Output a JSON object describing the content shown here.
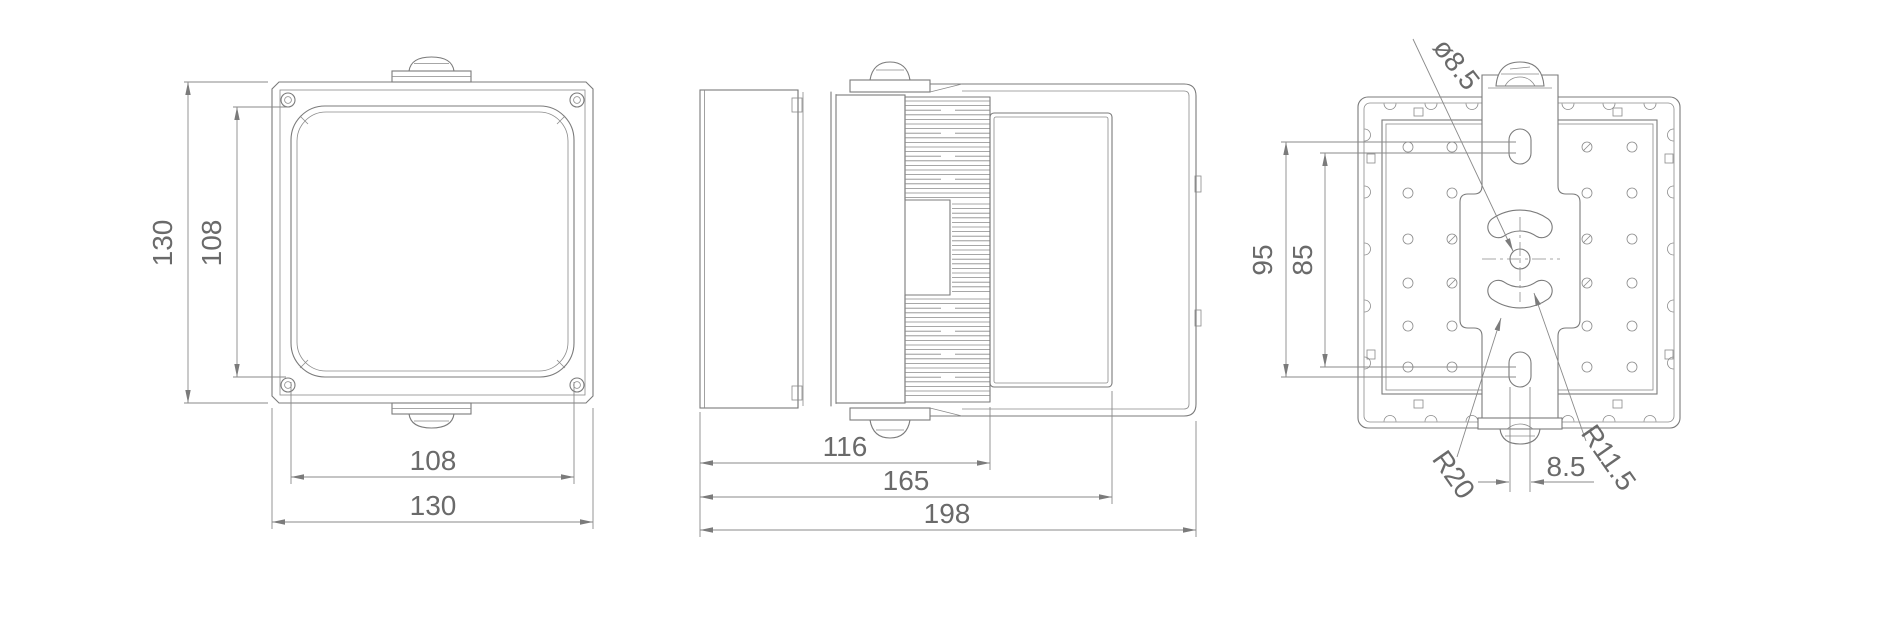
{
  "drawing": {
    "kind": "technical-orthographic-drawing",
    "line_color": "#7b7b7b",
    "text_color": "#6a6a6a",
    "background": "#ffffff",
    "views": {
      "front": {
        "dimensions": {
          "height_outer": "130",
          "height_inner": "108",
          "width_inner": "108",
          "width_outer": "130"
        }
      },
      "side": {
        "dimensions": {
          "depth_front": "116",
          "depth_mid": "165",
          "depth_overall": "198"
        }
      },
      "back": {
        "dimensions": {
          "hole_diameter": "ø8.5",
          "pitch_outer": "95",
          "pitch_inner": "85",
          "slot_width": "8.5",
          "radius_outer": "R20",
          "radius_inner": "R11.5"
        }
      }
    }
  }
}
